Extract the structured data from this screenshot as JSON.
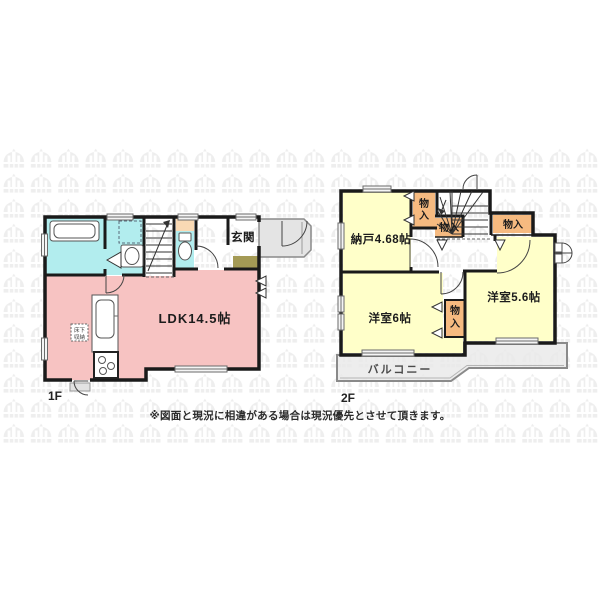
{
  "disclaimer": "※図面と現況に相違がある場合は現況優先とさせて頂きます。",
  "floor1": {
    "label": "1F",
    "ldk": "LDK14.5帖",
    "entrance": "玄関",
    "underfloor_line1": "床下",
    "underfloor_line2": "収納"
  },
  "floor2": {
    "label": "2F",
    "storage_room": "納戸4.68帖",
    "bedroom_6": "洋室6帖",
    "bedroom_56": "洋室5.6帖",
    "closet": "物入",
    "closet_char_1": "物",
    "closet_char_2": "入",
    "balcony": "バルコニー"
  },
  "colors": {
    "wall": "#1a1a1a",
    "ldk_pink": "#f7c3c2",
    "wet_area_cyan": "#b2edee",
    "tub_inner": "#d9f8f8",
    "room_yellow": "#ffffc9",
    "closet_orange": "#f6ba80",
    "toilet_shelf_peach": "#f9d9b4",
    "entry_mat_olive": "#a49a55",
    "porch_gray": "#e4e4e4",
    "balcony_gray": "#e8e8e8",
    "watermark_gray": "#eeeeee"
  }
}
